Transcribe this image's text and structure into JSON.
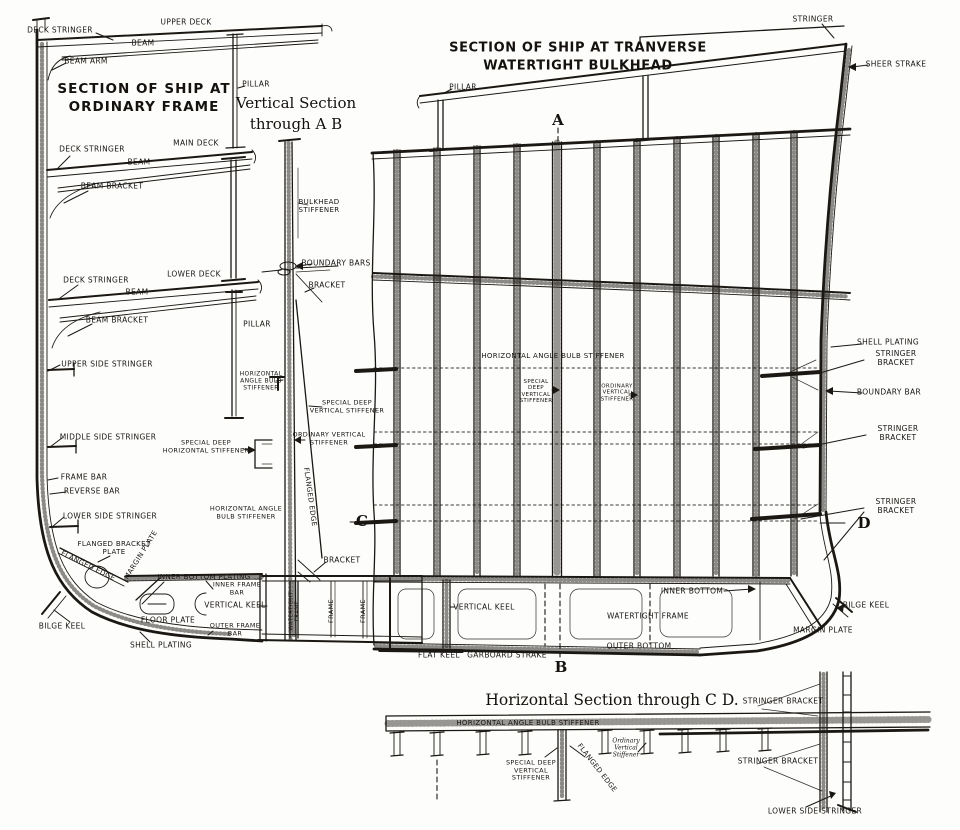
{
  "page": {
    "background": "#fdfdfb",
    "ink": "#1b1814"
  },
  "titles": {
    "left_section": "SECTION OF SHIP AT\nORDINARY FRAME",
    "right_section": "SECTION OF SHIP AT TRANVERSE\nWATERTIGHT BULKHEAD",
    "vertical_section": "Vertical Section\nthrough A B",
    "horizontal_section": "Horizontal Section through C D."
  },
  "markers": {
    "a": "A",
    "b": "B",
    "c": "C",
    "d": "D"
  },
  "labels": [
    {
      "n": "label-deck-stringer-top",
      "t": "DECK STRINGER",
      "x": 60,
      "y": 31
    },
    {
      "n": "label-upper-deck",
      "t": "UPPER DECK",
      "x": 186,
      "y": 23
    },
    {
      "n": "label-beam-upper",
      "t": "BEAM",
      "x": 143,
      "y": 44
    },
    {
      "n": "label-beam-arm",
      "t": "BEAM ARM",
      "x": 86,
      "y": 62
    },
    {
      "n": "label-pillar-upper",
      "t": "PILLAR",
      "x": 256,
      "y": 85
    },
    {
      "n": "label-deck-stringer-main",
      "t": "DECK STRINGER",
      "x": 92,
      "y": 150
    },
    {
      "n": "label-main-deck",
      "t": "MAIN DECK",
      "x": 196,
      "y": 144
    },
    {
      "n": "label-beam-main",
      "t": "BEAM",
      "x": 139,
      "y": 163
    },
    {
      "n": "label-beam-bracket-main",
      "t": "BEAM BRACKET",
      "x": 112,
      "y": 187
    },
    {
      "n": "label-deck-stringer-lower",
      "t": "DECK STRINGER",
      "x": 96,
      "y": 281
    },
    {
      "n": "label-lower-deck",
      "t": "LOWER DECK",
      "x": 194,
      "y": 275
    },
    {
      "n": "label-beam-lower",
      "t": "BEAM",
      "x": 137,
      "y": 293
    },
    {
      "n": "label-beam-bracket-lower",
      "t": "BEAM BRACKET",
      "x": 117,
      "y": 321
    },
    {
      "n": "label-pillar-lower",
      "t": "PILLAR",
      "x": 257,
      "y": 325
    },
    {
      "n": "label-upper-side-stringer",
      "t": "UPPER SIDE STRINGER",
      "x": 107,
      "y": 365
    },
    {
      "n": "label-middle-side-stringer",
      "t": "MIDDLE SIDE STRINGER",
      "x": 108,
      "y": 438
    },
    {
      "n": "label-frame-bar",
      "t": "FRAME BAR",
      "x": 84,
      "y": 478
    },
    {
      "n": "label-reverse-bar",
      "t": "REVERSE BAR",
      "x": 92,
      "y": 492
    },
    {
      "n": "label-lower-side-stringer",
      "t": "LOWER SIDE STRINGER",
      "x": 110,
      "y": 517
    },
    {
      "n": "label-flanged-bracket-plate",
      "t": "FLANGED BRACKET\nPLATE",
      "x": 114,
      "y": 548,
      "s": 7
    },
    {
      "n": "label-flanged-edge-left",
      "t": "FLANGED EDGE",
      "x": 88,
      "y": 566,
      "r": 26,
      "s": 7
    },
    {
      "n": "label-margin-plate-left",
      "t": "MARGIN PLATE",
      "x": 141,
      "y": 555,
      "r": -58,
      "s": 7
    },
    {
      "n": "label-inner-bottom-plating",
      "t": "INNER BOTTOM PLATING",
      "x": 204,
      "y": 577,
      "s": 7
    },
    {
      "n": "label-inner-frame-bar",
      "t": "INNER FRAME\nBAR",
      "x": 237,
      "y": 589,
      "s": 6.5
    },
    {
      "n": "label-vertical-keel-left",
      "t": "VERTICAL KEEL",
      "x": 235,
      "y": 606,
      "s": 7.5
    },
    {
      "n": "label-floor-plate",
      "t": "FLOOR PLATE",
      "x": 168,
      "y": 621
    },
    {
      "n": "label-outer-frame-bar",
      "t": "OUTER FRAME\nBAR",
      "x": 235,
      "y": 630,
      "s": 6.5
    },
    {
      "n": "label-bilge-keel-left",
      "t": "BILGE KEEL",
      "x": 62,
      "y": 627
    },
    {
      "n": "label-shell-plating-left",
      "t": "SHELL PLATING",
      "x": 161,
      "y": 646
    },
    {
      "n": "label-bulkhead-stiffener",
      "t": "BULKHEAD\nSTIFFENER",
      "x": 319,
      "y": 206,
      "s": 7
    },
    {
      "n": "label-boundary-bars",
      "t": "BOUNDARY BARS",
      "x": 336,
      "y": 264
    },
    {
      "n": "label-bracket-upper",
      "t": "BRACKET",
      "x": 327,
      "y": 286
    },
    {
      "n": "label-horiz-angle-bulb-stiffener-left",
      "t": "HORIZONTAL\nANGLE BULB\nSTIFFENER",
      "x": 261,
      "y": 381,
      "s": 6
    },
    {
      "n": "label-special-deep-vertical-stiffener-mid",
      "t": "SPECIAL DEEP\nVERTICAL STIFFENER",
      "x": 347,
      "y": 407,
      "s": 6.5
    },
    {
      "n": "label-ordinary-vertical-stiffener-mid",
      "t": "ORDINARY VERTICAL\nSTIFFENER",
      "x": 329,
      "y": 439,
      "s": 6.5
    },
    {
      "n": "label-special-deep-horizontal-stiffener",
      "t": "SPECIAL DEEP\nHORIZONTAL STIFFENER",
      "x": 206,
      "y": 447,
      "s": 6.5
    },
    {
      "n": "label-horiz-angle-bulb-stiffener-lower",
      "t": "HORIZONTAL ANGLE\nBULB STIFFENER",
      "x": 246,
      "y": 513,
      "s": 6.5
    },
    {
      "n": "label-flanged-edge-mid",
      "t": "FLANGED EDGE",
      "x": 310,
      "y": 497,
      "r": 82,
      "s": 7
    },
    {
      "n": "label-bracket-lower",
      "t": "BRACKET",
      "x": 342,
      "y": 561
    },
    {
      "n": "label-watertight-frame-mid",
      "t": "WATERTIGHT\nFRAME",
      "x": 295,
      "y": 611,
      "r": -90,
      "s": 5.5
    },
    {
      "n": "label-frame-1",
      "t": "FRAME",
      "x": 332,
      "y": 611,
      "r": -90,
      "s": 6.5
    },
    {
      "n": "label-frame-2",
      "t": "FRAME",
      "x": 364,
      "y": 611,
      "r": -90,
      "s": 6.5
    },
    {
      "n": "label-stringer-top",
      "t": "STRINGER",
      "x": 813,
      "y": 20
    },
    {
      "n": "label-sheer-strake",
      "t": "SHEER STRAKE",
      "x": 896,
      "y": 65
    },
    {
      "n": "label-pillar-right",
      "t": "PILLAR",
      "x": 463,
      "y": 88
    },
    {
      "n": "label-horiz-angle-bulb-stiffener-bulkhead",
      "t": "HORIZONTAL ANGLE BULB STIFFENER",
      "x": 553,
      "y": 356,
      "s": 7
    },
    {
      "n": "label-special-deep-vertical-stiffener-bulkhead",
      "t": "SPECIAL\nDEEP\nVERTICAL\nSTIFFENER",
      "x": 536,
      "y": 392,
      "s": 5.5
    },
    {
      "n": "label-ordinary-vertical-stiffener-bulkhead",
      "t": "ORDINARY\nVERTICAL\nSTIFFENER",
      "x": 617,
      "y": 393,
      "s": 5.5
    },
    {
      "n": "label-shell-plating-right",
      "t": "SHELL PLATING",
      "x": 888,
      "y": 343
    },
    {
      "n": "label-stringer-bracket-1",
      "t": "STRINGER BRACKET",
      "x": 896,
      "y": 359
    },
    {
      "n": "label-boundary-bar-right",
      "t": "BOUNDARY BAR",
      "x": 889,
      "y": 393
    },
    {
      "n": "label-stringer-bracket-2",
      "t": "STRINGER BRACKET",
      "x": 898,
      "y": 434
    },
    {
      "n": "label-stringer-bracket-3",
      "t": "STRINGER BRACKET",
      "x": 896,
      "y": 507
    },
    {
      "n": "label-inner-bottom-right",
      "t": "INNER BOTTOM",
      "x": 692,
      "y": 592
    },
    {
      "n": "label-vertical-keel-right",
      "t": "VERTICAL KEEL",
      "x": 484,
      "y": 608
    },
    {
      "n": "label-watertight-frame-right",
      "t": "WATERTIGHT FRAME",
      "x": 648,
      "y": 617
    },
    {
      "n": "label-outer-bottom",
      "t": "OUTER BOTTOM",
      "x": 639,
      "y": 647
    },
    {
      "n": "label-flat-keel",
      "t": "FLAT KEEL",
      "x": 439,
      "y": 656
    },
    {
      "n": "label-garboard-strake",
      "t": "GARBOARD STRAKE",
      "x": 507,
      "y": 656
    },
    {
      "n": "label-bilge-keel-right",
      "t": "BILGE KEEL",
      "x": 866,
      "y": 606
    },
    {
      "n": "label-margin-plate-right",
      "t": "MARGIN PLATE",
      "x": 823,
      "y": 631
    },
    {
      "n": "label-horiz-angle-bulb-stiffener-plan",
      "t": "HORIZONTAL ANGLE BULB STIFFENER",
      "x": 528,
      "y": 723,
      "s": 7
    },
    {
      "n": "label-special-deep-vertical-stiffener-plan",
      "t": "SPECIAL DEEP\nVERTICAL\nSTIFFENER",
      "x": 531,
      "y": 771,
      "s": 6.5
    },
    {
      "n": "label-flanged-edge-plan",
      "t": "FLANGED EDGE",
      "x": 597,
      "y": 768,
      "r": 52,
      "s": 7
    },
    {
      "n": "label-ordinary-vertical-stiffener-plan",
      "t": "Ordinary\nVertical\nStiffener",
      "x": 626,
      "y": 748,
      "s": 6,
      "i": 1
    },
    {
      "n": "label-stringer-bracket-plan-top",
      "t": "STRINGER BRACKET",
      "x": 783,
      "y": 702
    },
    {
      "n": "label-stringer-bracket-plan-bottom",
      "t": "STRINGER BRACKET",
      "x": 778,
      "y": 762
    },
    {
      "n": "label-lower-side-stringer-plan",
      "t": "LOWER SIDE STRINGER",
      "x": 815,
      "y": 812
    }
  ]
}
